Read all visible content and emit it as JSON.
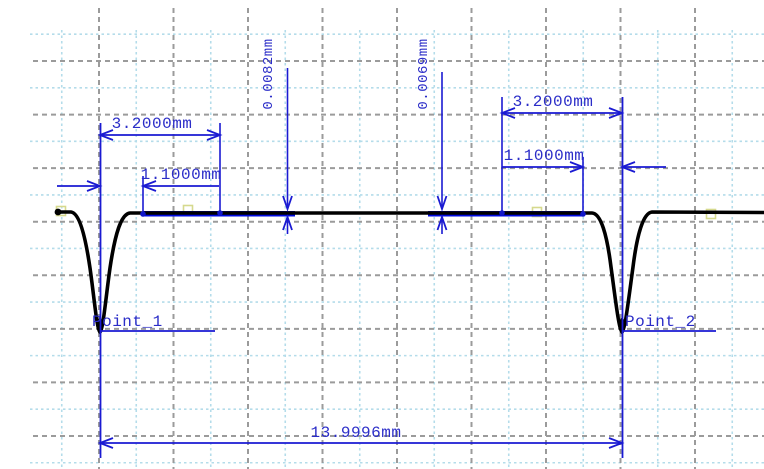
{
  "colors": {
    "background": "#ffffff",
    "dimension_blue": "#1a1ad2",
    "text_blue": "#2b2dc8",
    "measured_zone_blue": "#000ae0",
    "profile_black": "#000000",
    "grid_major_gray": "#9b9b9b",
    "grid_minor_cyan": "#b4dcea",
    "marker_yellow": "#d6d98e"
  },
  "annotations": {
    "left_group": {
      "zone_width": "3.2000mm",
      "edge_offset": "1.1000mm",
      "step_height": "0.0082mm",
      "point_label": "Point_1"
    },
    "right_group": {
      "zone_width": "3.2000mm",
      "edge_offset": "1.1000mm",
      "step_height": "0.0069mm",
      "point_label": "Point_2"
    },
    "total_distance": "13.9996mm",
    "unit": "mm"
  },
  "chart_data": {
    "type": "line",
    "title": "",
    "xlabel": "",
    "ylabel": "",
    "x_unit": "mm",
    "y_unit": "mm",
    "description": "Surface profile trace with two narrow grooves (Point_1, Point_2) on a flat surface; measured zones are highlighted in blue and dimensioned.",
    "points": [
      {
        "name": "Point_1",
        "x_mm": 0
      },
      {
        "name": "Point_2",
        "x_mm": 13.9996
      }
    ],
    "measurements": {
      "point_spacing_mm": 13.9996,
      "zone_width_mm": 3.2,
      "zone_edge_offset_from_point_mm": 1.1,
      "step_height_left_zone_mm": 0.0082,
      "step_height_right_zone_mm": 0.0069
    },
    "profile_polyline_px": [
      [
        58,
        212
      ],
      [
        72,
        212
      ],
      [
        100,
        332
      ],
      [
        129,
        213
      ],
      [
        593,
        213
      ],
      [
        622,
        332
      ],
      [
        652,
        212
      ],
      [
        764,
        212
      ]
    ],
    "measured_zones_px": [
      [
        143,
        295
      ],
      [
        428,
        583
      ]
    ],
    "grid": {
      "major_spacing_x_px": 74.5,
      "major_spacing_y_px": 53.57,
      "gridlines_on": true,
      "legend": "none"
    }
  }
}
